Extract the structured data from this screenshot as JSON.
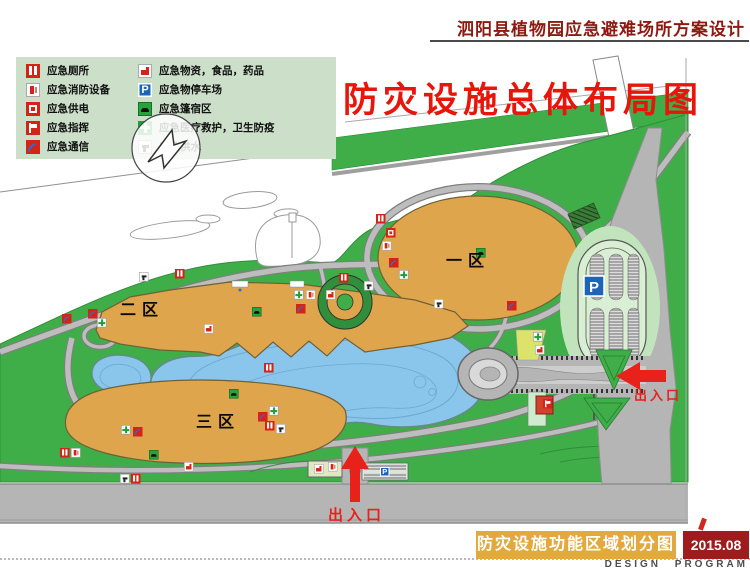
{
  "header": {
    "project_title": "泗阳县植物园应急避难场所方案设计"
  },
  "plan_title": "防灾设施总体布局图",
  "legend": {
    "left": [
      {
        "icon": "toilet-icon",
        "label": "应急厕所"
      },
      {
        "icon": "fire-equipment-icon",
        "label": "应急消防设备"
      },
      {
        "icon": "power-icon",
        "label": "应急供电"
      },
      {
        "icon": "command-icon",
        "label": "应急指挥"
      },
      {
        "icon": "telecom-icon",
        "label": "应急通信"
      }
    ],
    "right": [
      {
        "icon": "supplies-icon",
        "label": "应急物资，食品，药品"
      },
      {
        "icon": "parking-icon",
        "label": "应急物停车场"
      },
      {
        "icon": "tent-icon",
        "label": "应急篷宿区"
      },
      {
        "icon": "medical-icon",
        "label": "应急医疗救护，卫生防疫"
      },
      {
        "icon": "water-icon",
        "label": "应急供水"
      }
    ]
  },
  "map": {
    "zones": [
      {
        "id": "zone-1",
        "label": "一区"
      },
      {
        "id": "zone-2",
        "label": "二区"
      },
      {
        "id": "zone-3",
        "label": "三区"
      }
    ],
    "parking_sign": "P",
    "entrances": {
      "right": "出入口",
      "bottom": "出入口"
    },
    "facilities": [
      {
        "t": "toilet",
        "x": 376,
        "y": 214
      },
      {
        "t": "power",
        "x": 386,
        "y": 228
      },
      {
        "t": "fire",
        "x": 382,
        "y": 241
      },
      {
        "t": "phone",
        "x": 389,
        "y": 258
      },
      {
        "t": "medical",
        "x": 399,
        "y": 270
      },
      {
        "t": "water",
        "x": 434,
        "y": 299
      },
      {
        "t": "phone",
        "x": 507,
        "y": 301
      },
      {
        "t": "tent",
        "x": 476,
        "y": 248
      },
      {
        "t": "toilet",
        "x": 175,
        "y": 269
      },
      {
        "t": "water",
        "x": 139,
        "y": 272
      },
      {
        "t": "phone",
        "x": 88,
        "y": 309
      },
      {
        "t": "medical",
        "x": 97,
        "y": 318
      },
      {
        "t": "tent",
        "x": 252,
        "y": 307
      },
      {
        "t": "supplies",
        "x": 204,
        "y": 324
      },
      {
        "t": "toilet",
        "x": 264,
        "y": 363
      },
      {
        "t": "tent",
        "x": 229,
        "y": 389
      },
      {
        "t": "medical",
        "x": 121,
        "y": 425
      },
      {
        "t": "phone",
        "x": 133,
        "y": 427
      },
      {
        "t": "tent",
        "x": 149,
        "y": 450
      },
      {
        "t": "supplies",
        "x": 184,
        "y": 462
      },
      {
        "t": "phone",
        "x": 258,
        "y": 412
      },
      {
        "t": "medical",
        "x": 269,
        "y": 406
      },
      {
        "t": "toilet",
        "x": 265,
        "y": 421
      },
      {
        "t": "water",
        "x": 276,
        "y": 424
      },
      {
        "t": "toilet",
        "x": 339,
        "y": 273
      },
      {
        "t": "water",
        "x": 364,
        "y": 281
      },
      {
        "t": "medical",
        "x": 294,
        "y": 290
      },
      {
        "t": "fire",
        "x": 306,
        "y": 290
      },
      {
        "t": "supplies",
        "x": 326,
        "y": 290
      },
      {
        "t": "phone",
        "x": 296,
        "y": 304
      },
      {
        "t": "medical",
        "x": 533,
        "y": 332
      },
      {
        "t": "supplies",
        "x": 535,
        "y": 345
      },
      {
        "t": "command",
        "x": 543,
        "y": 399
      },
      {
        "t": "supplies",
        "x": 314,
        "y": 464
      },
      {
        "t": "fire",
        "x": 328,
        "y": 462
      },
      {
        "t": "parking",
        "x": 380,
        "y": 467
      },
      {
        "t": "phone",
        "x": 62,
        "y": 314
      },
      {
        "t": "toilet",
        "x": 60,
        "y": 448
      },
      {
        "t": "fire",
        "x": 71,
        "y": 448
      },
      {
        "t": "water",
        "x": 120,
        "y": 474
      },
      {
        "t": "toilet",
        "x": 131,
        "y": 474
      }
    ]
  },
  "footer": {
    "drawing_name": "防灾设施功能区域划分图",
    "date": "2015.08",
    "credit": "DESIGN PROGRAM"
  },
  "colors": {
    "park_green": "#3fae49",
    "zone_orange": "#dfa54c",
    "lake_blue": "#8ac6ec",
    "road_gray": "#b5b5b5",
    "accent_red": "#e8211a",
    "title_red": "#e8150b",
    "header_red": "#8c1a11",
    "footer_orange": "#e3a93e",
    "footer_darkred": "#9e1c1c",
    "icon_red": "#d42417",
    "icon_blue": "#1c64b8",
    "icon_green": "#1f9e3e",
    "legend_bg": "#ccdfc9"
  }
}
